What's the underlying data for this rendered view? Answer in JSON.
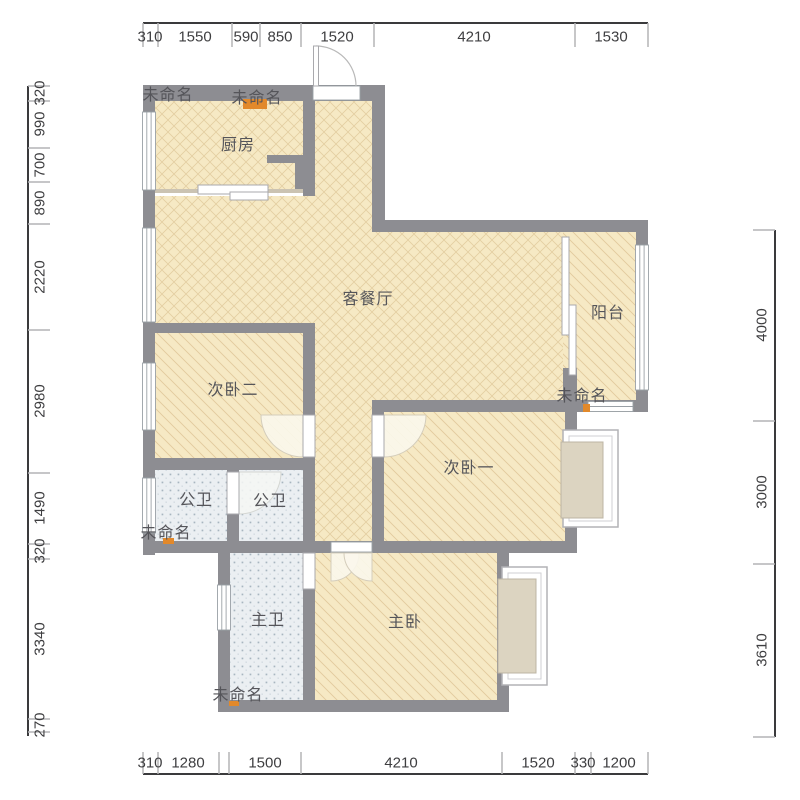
{
  "rooms": {
    "kitchen": "厨房",
    "living_dining": "客餐厅",
    "balcony": "阳台",
    "bedroom2": "次卧二",
    "bedroom1": "次卧一",
    "bath_public": "公卫",
    "master_bath": "主卫",
    "master_bedroom": "主卧",
    "unnamed": "未命名"
  },
  "dims": {
    "top": [
      "310",
      "1550",
      "590",
      "850",
      "1520",
      "4210",
      "1530"
    ],
    "bottom": [
      "310",
      "1280",
      "1500",
      "4210",
      "1520",
      "330",
      "1200"
    ],
    "left": [
      "320",
      "990",
      "700",
      "890",
      "2220",
      "2980",
      "1490",
      "320",
      "3340",
      "270"
    ],
    "right": [
      "4000",
      "3000",
      "3610"
    ]
  },
  "palette": {
    "wall": "#8d8d92",
    "floor": "#f6e9c4",
    "floor_hatch": "#c09a5e",
    "tile_floor": "#ebeff2",
    "tile_dot": "#a8b5c0",
    "bay_fill": "#dcd4c1",
    "accent_orange": "#e2892b",
    "dim_line": "#3a3a3c",
    "dim_tick": "#b4b4b6"
  }
}
